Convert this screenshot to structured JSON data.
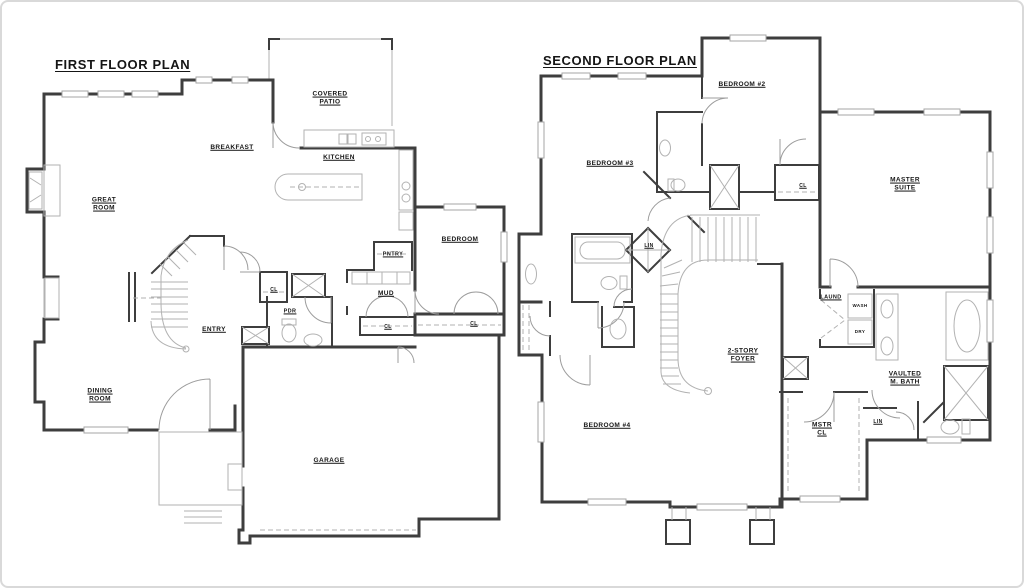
{
  "colors": {
    "background": "#ffffff",
    "border": "#d9d9d9",
    "wall": "#3e3e3e",
    "fixture": "#b2b2b2",
    "door": "#9c9c9c",
    "text": "#151515"
  },
  "plans": [
    {
      "name": "first-floor",
      "title": "FIRST FLOOR PLAN",
      "title_pos": {
        "x": 53,
        "y": 55
      },
      "labels": [
        {
          "t": "GREAT\nROOM",
          "x": 102,
          "y": 203
        },
        {
          "t": "BREAKFAST",
          "x": 230,
          "y": 146
        },
        {
          "t": "COVERED\nPATIO",
          "x": 328,
          "y": 97
        },
        {
          "t": "KITCHEN",
          "x": 337,
          "y": 156
        },
        {
          "t": "PNTRY",
          "x": 391,
          "y": 253,
          "s": 5.5
        },
        {
          "t": "BEDROOM",
          "x": 458,
          "y": 238
        },
        {
          "t": "CL",
          "x": 272,
          "y": 288,
          "s": 5
        },
        {
          "t": "PDR",
          "x": 288,
          "y": 310,
          "s": 5.5
        },
        {
          "t": "MUD",
          "x": 384,
          "y": 292
        },
        {
          "t": "CL",
          "x": 386,
          "y": 325,
          "s": 5
        },
        {
          "t": "CL",
          "x": 472,
          "y": 322,
          "s": 5
        },
        {
          "t": "ENTRY",
          "x": 212,
          "y": 328
        },
        {
          "t": "DINING\nROOM",
          "x": 98,
          "y": 394
        },
        {
          "t": "GARAGE",
          "x": 327,
          "y": 459
        }
      ]
    },
    {
      "name": "second-floor",
      "title": "SECOND FLOOR PLAN",
      "title_pos": {
        "x": 541,
        "y": 51
      },
      "labels": [
        {
          "t": "BEDROOM #2",
          "x": 740,
          "y": 83
        },
        {
          "t": "BEDROOM #3",
          "x": 608,
          "y": 162
        },
        {
          "t": "MASTER\nSUITE",
          "x": 903,
          "y": 183
        },
        {
          "t": "CL",
          "x": 801,
          "y": 184,
          "s": 5
        },
        {
          "t": "LIN",
          "x": 647,
          "y": 244,
          "s": 5
        },
        {
          "t": "LAUND",
          "x": 829,
          "y": 296,
          "s": 5.5
        },
        {
          "t": "WASH",
          "x": 858,
          "y": 304,
          "s": 4.5,
          "u": false
        },
        {
          "t": "DRY",
          "x": 858,
          "y": 330,
          "s": 4.5,
          "u": false
        },
        {
          "t": "2-STORY\nFOYER",
          "x": 741,
          "y": 354
        },
        {
          "t": "VAULTED\nM. BATH",
          "x": 903,
          "y": 377
        },
        {
          "t": "MSTR\nCL",
          "x": 820,
          "y": 428
        },
        {
          "t": "LIN",
          "x": 876,
          "y": 420,
          "s": 5
        },
        {
          "t": "BEDROOM #4",
          "x": 605,
          "y": 424
        }
      ]
    }
  ]
}
